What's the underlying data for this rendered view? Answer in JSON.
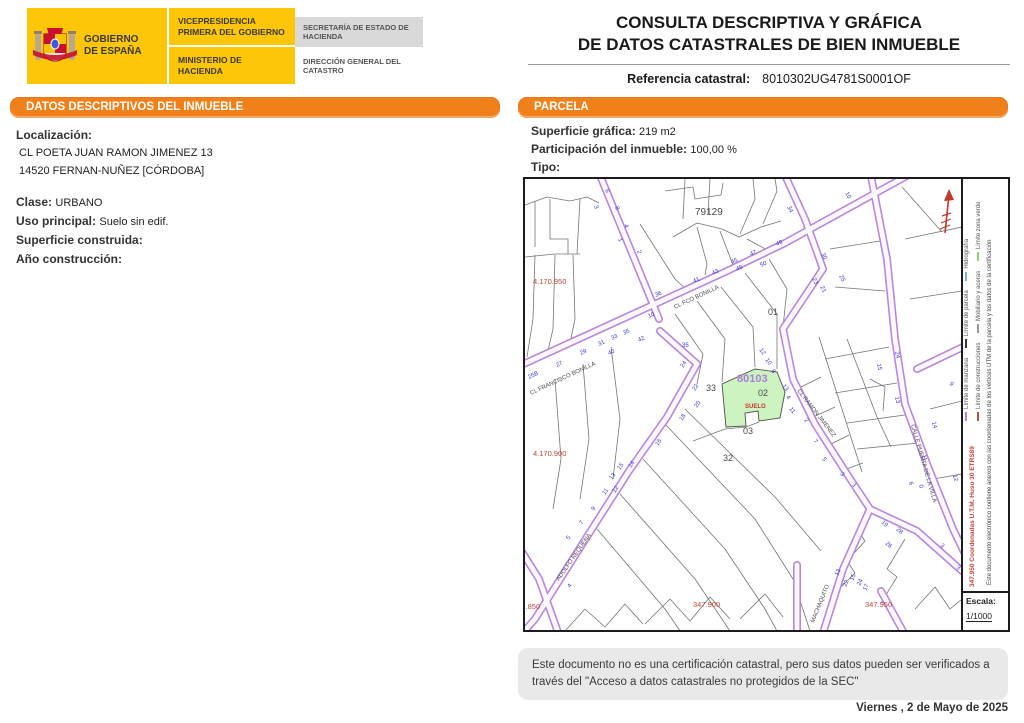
{
  "header": {
    "gobierno_l1": "GOBIERNO",
    "gobierno_l2": "DE ESPAÑA",
    "vicepresidencia": "VICEPRESIDENCIA PRIMERA DEL GOBIERNO",
    "ministerio": "MINISTERIO DE HACIENDA",
    "secretaria": "SECRETARÍA DE ESTADO DE HACIENDA",
    "direccion": "DIRECCIÓN GENERAL DEL CATASTRO",
    "title_line1": "CONSULTA DESCRIPTIVA Y GRÁFICA",
    "title_line2": "DE DATOS CATASTRALES DE BIEN INMUEBLE",
    "ref_label": "Referencia catastral:",
    "ref_value": "8010302UG4781S0001OF"
  },
  "left_panel": {
    "title": "DATOS DESCRIPTIVOS DEL INMUEBLE",
    "localizacion_label": "Localización:",
    "address_line1": "CL POETA JUAN RAMON JIMENEZ 13",
    "address_line2": "14520 FERNAN-NUÑEZ [CÓRDOBA]",
    "clase_label": "Clase:",
    "clase_value": "URBANO",
    "uso_label": "Uso principal:",
    "uso_value": "Suelo sin edif.",
    "superficie_label": "Superficie construida:",
    "superficie_value": "",
    "anio_label": "Año construcción:",
    "anio_value": ""
  },
  "right_panel": {
    "title": "PARCELA",
    "superficie_label": "Superficie gráfica:",
    "superficie_value": "219 m2",
    "participacion_label": "Participación del inmueble:",
    "participacion_value": "100,00 %",
    "tipo_label": "Tipo:",
    "tipo_value": ""
  },
  "map": {
    "colors": {
      "street_edge": "#bb86dd",
      "street_core": "#fdfaff",
      "parcel_line": "#757575",
      "subject_fill": "#cdf3c0",
      "number": "#3b3bd0",
      "label": "#4a4a4a",
      "coord_red": "#c4453a",
      "ref_violet": "#a97fd6"
    },
    "streets": [
      {
        "id": "francisco-bonilla",
        "path": "M -8 188 L 60 157 L 200 93 L 260 64 L 398 -12"
      },
      {
        "id": "north-branch",
        "path": "M 74 -6 L 134 140"
      },
      {
        "id": "north-branch-east",
        "path": "M 258 -8 L 280 40 L 298 90"
      },
      {
        "id": "ramon-jimenez",
        "path": "M 298 90 L 258 150 L 268 200 L 290 245 L 322 295 L 345 330"
      },
      {
        "id": "machaquito",
        "path": "M 345 330 L 318 390 L 298 454"
      },
      {
        "id": "southeast-branch",
        "path": "M 345 330 L 392 352 L 437 392"
      },
      {
        "id": "puerta-de-la-villa",
        "path": "M 345 -8 L 362 80 L 370 160 L 380 225 L 402 285 L 428 350 L 440 375"
      },
      {
        "id": "east-stub",
        "path": "M 392 190 L 440 167"
      },
      {
        "id": "adolfo-requena",
        "path": "M 135 152 L 172 185 L 142 238 L 104 292 L 58 364 L 10 440 L -4 456"
      },
      {
        "id": "west-stub",
        "path": "M -6 368 L 14 400 L 34 456"
      },
      {
        "id": "south-stub-1",
        "path": "M 272 386 L 272 456"
      },
      {
        "id": "south-stub-2",
        "path": "M 356 412 L 380 456"
      }
    ],
    "parcel_lines": [
      "M 10 22 L 10 68",
      "M 25 20 L 25 60 L 43 60 L 43 75",
      "M 55 20 L 52 75",
      "M 0 26 L 22 18 L 45 22 L 62 18 L 74 24",
      "M 0 78 L 30 75 L 55 75",
      "M 10 76 L 8 140 L 2 178",
      "M 30 76 L 28 150 L 22 176",
      "M 48 76 L 50 140 L 45 164",
      "M 115 45 L 150 100 L 163 112",
      "M 160 0 L 158 40",
      "M 185 0 L 183 35",
      "M 148 58 L 172 44 L 197 50 L 214 58 L 236 48 L 256 42",
      "M 172 48 L 182 85 L 180 96",
      "M 195 52 L 208 86",
      "M 140 12 L 168 8 L 170 20 L 196 16 L 198 4",
      "M 215 55 L 230 20 L 228 0",
      "M 238 45 L 252 12 L 250 0",
      "M 222 60 L 244 72",
      "M 377 8 L 417 53",
      "M 305 70 L 355 62",
      "M 310 108 L 360 112",
      "M 380 60 L 437 48",
      "M 385 120 L 437 112",
      "M 294 158 L 337 293",
      "M 322 160 L 352 238 L 366 268",
      "M 272 210 L 296 198",
      "M 284 240 L 310 228",
      "M 300 268 L 324 256",
      "M 316 292 L 338 284",
      "M 300 180 L 364 168",
      "M 310 214 L 372 204",
      "M 322 244 L 380 236",
      "M 332 270 L 394 264",
      "M 405 230 L 437 222",
      "M 408 300 L 437 295",
      "M 150 135 L 178 175 L 172 205",
      "M 172 122 L 200 160 L 197 203",
      "M 196 108 L 228 148 L 230 188",
      "M 220 94 L 252 135 L 252 190",
      "M 244 80 L 262 110 L 258 148",
      "M 168 262 L 200 250 L 221 248 L 234 243",
      "M 140 245 L 230 340 L 268 400 L 285 452",
      "M 160 230 L 250 318 L 296 372",
      "M 118 280 L 200 370 L 240 430 L 252 452",
      "M 95 315 L 170 400 L 205 452",
      "M 72 350 L 140 430 L 158 456",
      "M 30 200 L 36 280 L 28 330",
      "M 58 185 L 64 260 L 55 320",
      "M 86 168 L 95 240 L 88 300",
      "M 40 452 L 60 430 L 80 448 L 100 425 L 118 445",
      "M 120 445 L 145 420 L 165 442 L 185 418 L 205 440",
      "M 215 440 L 240 415 L 258 438",
      "M 352 330 L 332 350 L 340 362 L 322 382 L 330 394 L 312 412",
      "M 380 360 L 362 390 L 372 398 L 356 424",
      "M 390 430 L 410 408 L 425 430 L 437 420",
      "M 345 200 L 360 208 L 358 232"
    ],
    "subject_parcel_path": "M 197 205 L 230 190 L 252 193 L 260 213 L 255 239 L 234 242 L 233 232 L 220 234 L 221 247 L 201 248 Z",
    "labels": [
      {
        "t": "79129",
        "x": 170,
        "y": 36,
        "s": 10,
        "n": "block-label-79129"
      },
      {
        "t": "01",
        "x": 243,
        "y": 136,
        "s": 9,
        "n": "parcel-label-01"
      },
      {
        "t": "80103",
        "x": 212,
        "y": 203,
        "s": 11,
        "c": "#a97fd6",
        "b": true,
        "n": "subject-block-ref"
      },
      {
        "t": "02",
        "x": 233,
        "y": 217,
        "s": 9,
        "n": "subject-parcel-number"
      },
      {
        "t": "SUELO",
        "x": 220,
        "y": 229,
        "s": 6,
        "c": "#c4342c",
        "b": true,
        "n": "subject-parcel-use"
      },
      {
        "t": "03",
        "x": 218,
        "y": 255,
        "s": 9,
        "n": "parcel-label-03"
      },
      {
        "t": "32",
        "x": 198,
        "y": 282,
        "s": 9,
        "n": "parcel-label-32"
      },
      {
        "t": "33",
        "x": 181,
        "y": 212,
        "s": 9,
        "n": "parcel-label-33"
      },
      {
        "t": "4.170.950",
        "x": 8,
        "y": 105,
        "s": 7.5,
        "c": "#c4453a",
        "n": "utm-y-coordinate"
      },
      {
        "t": "4.170.900",
        "x": 8,
        "y": 277,
        "s": 7.5,
        "c": "#c4453a",
        "n": "utm-y-coordinate"
      },
      {
        "t": "347.850",
        "x": -12,
        "y": 430,
        "s": 7.5,
        "c": "#c4453a",
        "n": "utm-x-coordinate"
      },
      {
        "t": "347.900",
        "x": 168,
        "y": 428,
        "s": 7.5,
        "c": "#c4453a",
        "n": "utm-x-coordinate"
      },
      {
        "t": "347.950",
        "x": 340,
        "y": 428,
        "s": 7.5,
        "c": "#c4453a",
        "n": "utm-x-coordinate"
      },
      {
        "t": "CL FRANCISCO BONILLA",
        "x": 6,
        "y": 216,
        "s": 6,
        "r": -25,
        "n": "street-name"
      },
      {
        "t": "CL FCO BONILLA",
        "x": 150,
        "y": 130,
        "s": 6,
        "r": -25,
        "n": "street-name"
      },
      {
        "t": "CL RAMON JIMENEZ",
        "x": 272,
        "y": 212,
        "s": 6,
        "r": 52,
        "n": "street-name"
      },
      {
        "t": "CALLE PUERTA DE LA VILLA",
        "x": 386,
        "y": 246,
        "s": 6,
        "r": 74,
        "n": "street-name"
      },
      {
        "t": "ADOLFO REQUENA",
        "x": 34,
        "y": 402,
        "s": 6,
        "r": -55,
        "n": "street-name"
      },
      {
        "t": "MACHAQUITO",
        "x": 289,
        "y": 444,
        "s": 6,
        "r": -68,
        "n": "street-name"
      }
    ],
    "house_numbers": [
      [
        "25B",
        4,
        200,
        -25
      ],
      [
        "27",
        32,
        188,
        -25
      ],
      [
        "29",
        56,
        176,
        -25
      ],
      [
        "31",
        74,
        167,
        -25
      ],
      [
        "33",
        87,
        161,
        -25
      ],
      [
        "35",
        99,
        156,
        -25
      ],
      [
        "40",
        84,
        176,
        -25
      ],
      [
        "42",
        114,
        163,
        -25
      ],
      [
        "10",
        124,
        139,
        -25
      ],
      [
        "36",
        131,
        118,
        -25
      ],
      [
        "41",
        169,
        104,
        -25
      ],
      [
        "43",
        188,
        96,
        -25
      ],
      [
        "45",
        207,
        85,
        -25
      ],
      [
        "47",
        226,
        77,
        -25
      ],
      [
        "48",
        212,
        92,
        -25
      ],
      [
        "50",
        236,
        88,
        -25
      ],
      [
        "49",
        252,
        67,
        -25
      ],
      [
        "6",
        80,
        11,
        70
      ],
      [
        "3",
        69,
        27,
        70
      ],
      [
        "8",
        90,
        28,
        70
      ],
      [
        "4",
        99,
        46,
        70
      ],
      [
        "1",
        93,
        60,
        70
      ],
      [
        "2",
        112,
        72,
        70
      ],
      [
        "34",
        262,
        28,
        62
      ],
      [
        "10",
        320,
        14,
        62
      ],
      [
        "30",
        296,
        75,
        62
      ],
      [
        "23",
        287,
        100,
        62
      ],
      [
        "21",
        295,
        108,
        62
      ],
      [
        "25",
        314,
        97,
        62
      ],
      [
        "12",
        234,
        171,
        52
      ],
      [
        "10",
        240,
        181,
        52
      ],
      [
        "8",
        246,
        192,
        52
      ],
      [
        "13",
        257,
        207,
        52
      ],
      [
        "4",
        261,
        218,
        52
      ],
      [
        "11",
        264,
        230,
        52
      ],
      [
        "2",
        279,
        241,
        52
      ],
      [
        "7",
        288,
        262,
        52
      ],
      [
        "5",
        297,
        280,
        52
      ],
      [
        "3",
        315,
        295,
        52
      ],
      [
        "1",
        327,
        306,
        52
      ],
      [
        "35",
        157,
        168,
        0
      ],
      [
        "24",
        370,
        173,
        78
      ],
      [
        "15",
        352,
        185,
        78
      ],
      [
        "13",
        370,
        218,
        78
      ],
      [
        "14",
        407,
        243,
        78
      ],
      [
        "11",
        397,
        276,
        78
      ],
      [
        "12",
        428,
        296,
        78
      ],
      [
        "9",
        424,
        205,
        45
      ],
      [
        "6",
        384,
        303,
        78
      ],
      [
        "0",
        394,
        306,
        78
      ],
      [
        "19",
        356,
        344,
        40
      ],
      [
        "28",
        371,
        351,
        40
      ],
      [
        "26",
        360,
        365,
        40
      ],
      [
        "3",
        415,
        367,
        40
      ],
      [
        "3",
        431,
        389,
        40
      ],
      [
        "13",
        313,
        397,
        -65
      ],
      [
        "15",
        328,
        402,
        -65
      ],
      [
        "17",
        341,
        412,
        -65
      ],
      [
        "22",
        321,
        408,
        -65
      ],
      [
        "24",
        335,
        407,
        -65
      ],
      [
        "24",
        158,
        189,
        -55
      ],
      [
        "22",
        170,
        212,
        -55
      ],
      [
        "20",
        172,
        229,
        -55
      ],
      [
        "18",
        157,
        242,
        -55
      ],
      [
        "16",
        133,
        267,
        -55
      ],
      [
        "14",
        106,
        289,
        -55
      ],
      [
        "15",
        95,
        291,
        -55
      ],
      [
        "13",
        87,
        301,
        -55
      ],
      [
        "11",
        80,
        316,
        -55
      ],
      [
        "12",
        90,
        314,
        -55
      ],
      [
        "9",
        69,
        332,
        -55
      ],
      [
        "7",
        57,
        346,
        -55
      ],
      [
        "5",
        44,
        361,
        -55
      ],
      [
        "4",
        45,
        409,
        -55
      ]
    ],
    "legend": {
      "row1": [
        {
          "label": "Límite de manzana",
          "color": "#b57edb"
        },
        {
          "label": "Límite de parcela",
          "color": "#3a3a3a"
        },
        {
          "label": "Hidrografía",
          "color": "#7bafe0"
        }
      ],
      "row2": [
        {
          "label": "Límite de construcciones",
          "color": "#b4554a"
        },
        {
          "label": "Mobiliario y aceras",
          "color": "#9a9a9a"
        },
        {
          "label": "Límite zona verde",
          "color": "#8fd07c"
        }
      ]
    },
    "coords_text": "347.950 Coordenadas U.T.M. Huso 30 ETRS89",
    "cert_text": "Este documento electrónico contiene anexos con las coordenadas de los vértices UTM de la parcela y los datos de la certificación",
    "escala_label": "Escala:",
    "escala_value": "1/1000"
  },
  "footer": {
    "disclaimer": "Este documento no es una certificación catastral, pero sus datos pueden ser verificados a través del \"Acceso a datos catastrales no protegidos de la SEC\"",
    "date": "Viernes , 2 de Mayo de 2025"
  }
}
